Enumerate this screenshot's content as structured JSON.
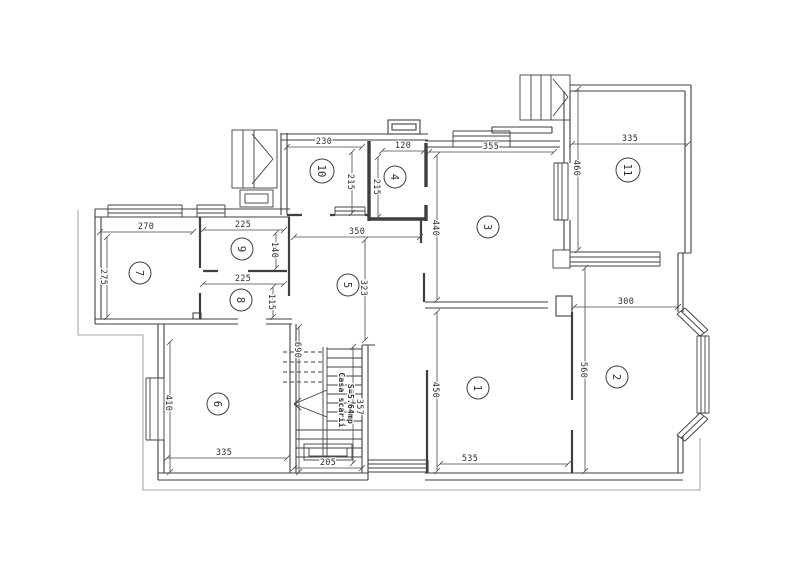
{
  "colors": {
    "ink": "#3f3f3f",
    "text": "#2e2e2e",
    "paper": "#ffffff"
  },
  "plan": {
    "rooms": [
      {
        "number": "1"
      },
      {
        "number": "2"
      },
      {
        "number": "3"
      },
      {
        "number": "4"
      },
      {
        "number": "5"
      },
      {
        "number": "6"
      },
      {
        "number": "7"
      },
      {
        "number": "8"
      },
      {
        "number": "9"
      },
      {
        "number": "10"
      },
      {
        "number": "11"
      }
    ],
    "dimensions": {
      "room1": {
        "width": "535",
        "height": "450"
      },
      "room2": {
        "width": "300",
        "height": "560"
      },
      "room3": {
        "width": "355",
        "height": "440"
      },
      "room4": {
        "width": "120",
        "height": "215"
      },
      "room5": {
        "width": "350",
        "height": "323"
      },
      "room6": {
        "width": "335",
        "height": "410"
      },
      "room7": {
        "width": "270",
        "height": "275"
      },
      "room8": {
        "width": "225",
        "height": "115"
      },
      "room9": {
        "width": "225",
        "height": "140"
      },
      "room10": {
        "width": "230",
        "height": "215"
      },
      "room11": {
        "width": "335",
        "height": "460"
      },
      "hall": {
        "height": "690"
      },
      "stairwell": {
        "width": "205",
        "height": "357"
      }
    },
    "stairwell": {
      "name": "Casa scarii",
      "area": "S=5.64mp"
    }
  }
}
